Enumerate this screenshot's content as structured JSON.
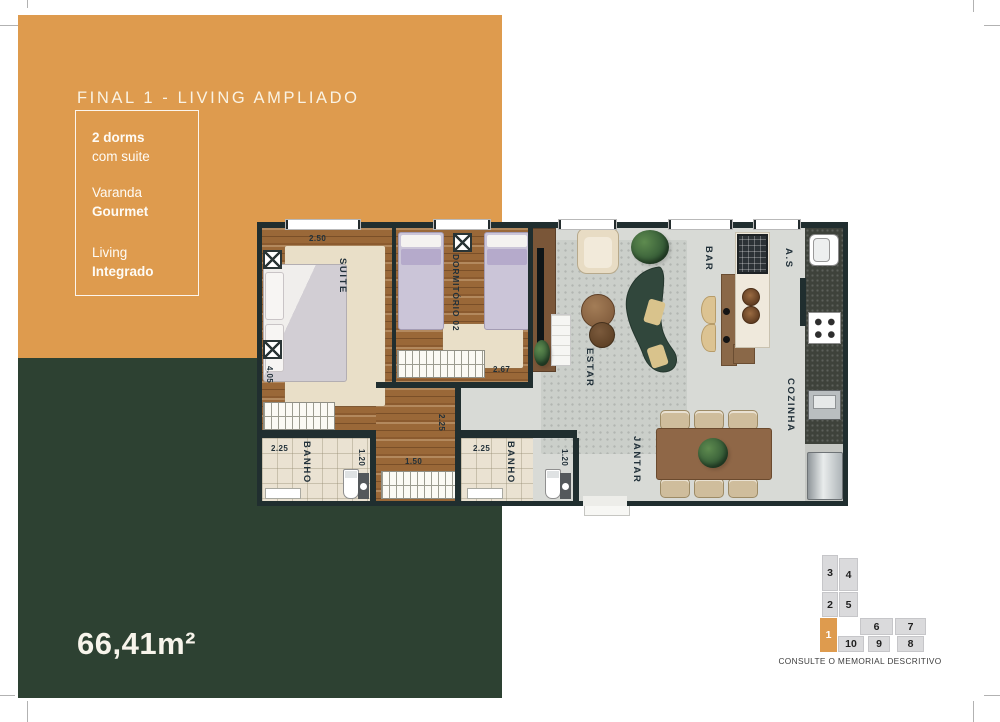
{
  "brochure": {
    "title": "FINAL 1 - LIVING AMPLIADO",
    "area": "66,41m²",
    "features": [
      {
        "line1": "2 dorms",
        "line2": "com suite"
      },
      {
        "line1": "Varanda",
        "line2": "Gourmet"
      },
      {
        "line1": "Living",
        "line2": "Integrado"
      }
    ],
    "colors": {
      "accent_orange": "#DE9B4E",
      "panel_green": "#2D4132",
      "wall_dark": "#202E2F"
    }
  },
  "floorplan": {
    "rooms": {
      "suite": "SUITE",
      "dorm02": "DORMITÓRIO 02",
      "banho1": "BANHO",
      "banho2": "BANHO",
      "estar": "ESTAR",
      "jantar": "JANTAR",
      "bar": "BAR",
      "servico": "A.S",
      "cozinha": "COZINHA"
    },
    "dims": {
      "suite_top": "2.50",
      "suite_side": "4.05",
      "dorm_bottom": "2.67",
      "banho1_top": "2.25",
      "banho1_side": "1.20",
      "hall_closet": "1.50",
      "hall_corridor": "2.25",
      "banho2_top": "2.25",
      "banho2_side": "1.20"
    }
  },
  "keyplan": {
    "note": "CONSULTE O MEMORIAL DESCRITIVO",
    "highlighted_unit": "1",
    "units": [
      {
        "label": "3"
      },
      {
        "label": "4"
      },
      {
        "label": "2"
      },
      {
        "label": "5"
      },
      {
        "label": "1"
      },
      {
        "label": "6"
      },
      {
        "label": "7"
      },
      {
        "label": "10"
      },
      {
        "label": "9"
      },
      {
        "label": "8"
      }
    ]
  }
}
